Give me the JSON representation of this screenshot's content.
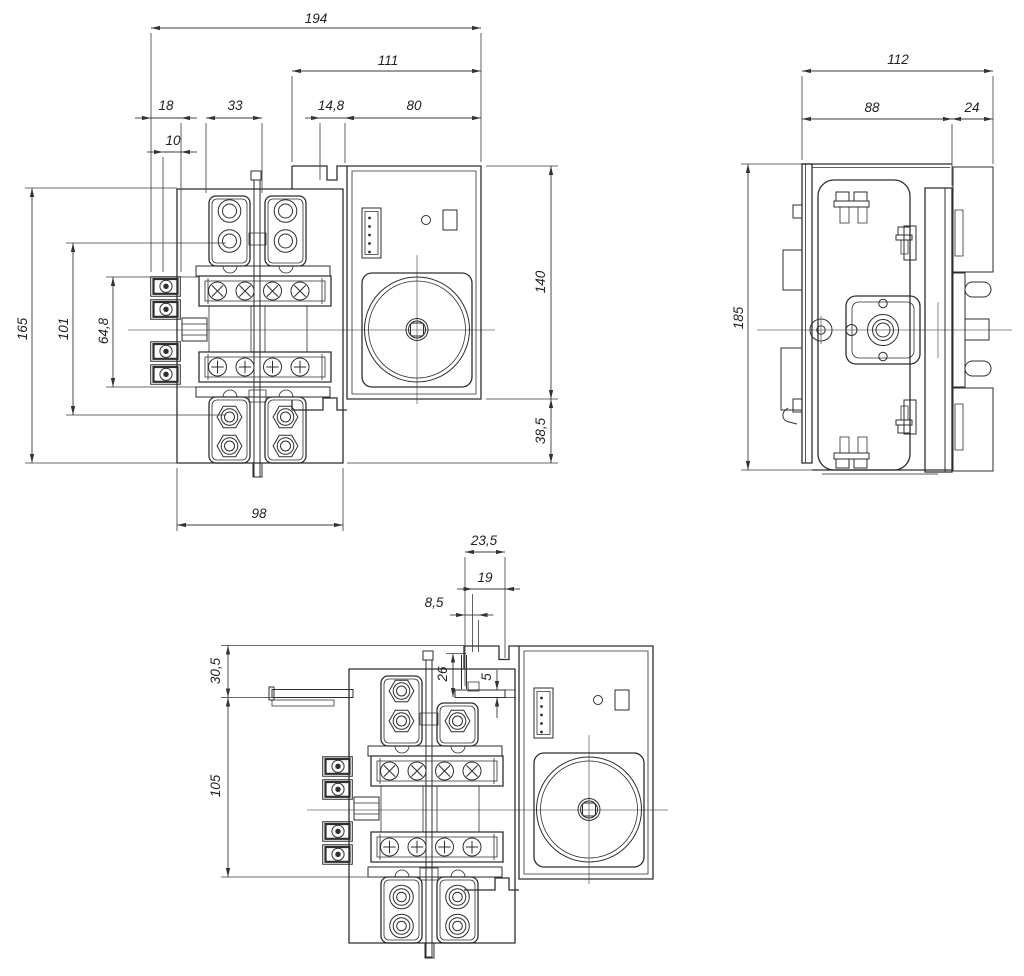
{
  "drawing": {
    "background": "#ffffff",
    "line_color": "#2e2e2e",
    "dim_color": "#222222",
    "dims": {
      "d194": "194",
      "d111": "111",
      "d18": "18",
      "d10": "10",
      "d33": "33",
      "d148": "14,8",
      "d80": "80",
      "d165": "165",
      "d101": "101",
      "d648": "64,8",
      "d140": "140",
      "d385": "38,5",
      "d98": "98",
      "d112": "112",
      "d88": "88",
      "d24": "24",
      "d185": "185",
      "d235": "23,5",
      "d19": "19",
      "d85": "8,5",
      "d26": "26",
      "d5": "5",
      "d305": "30,5",
      "d105": "105"
    }
  }
}
